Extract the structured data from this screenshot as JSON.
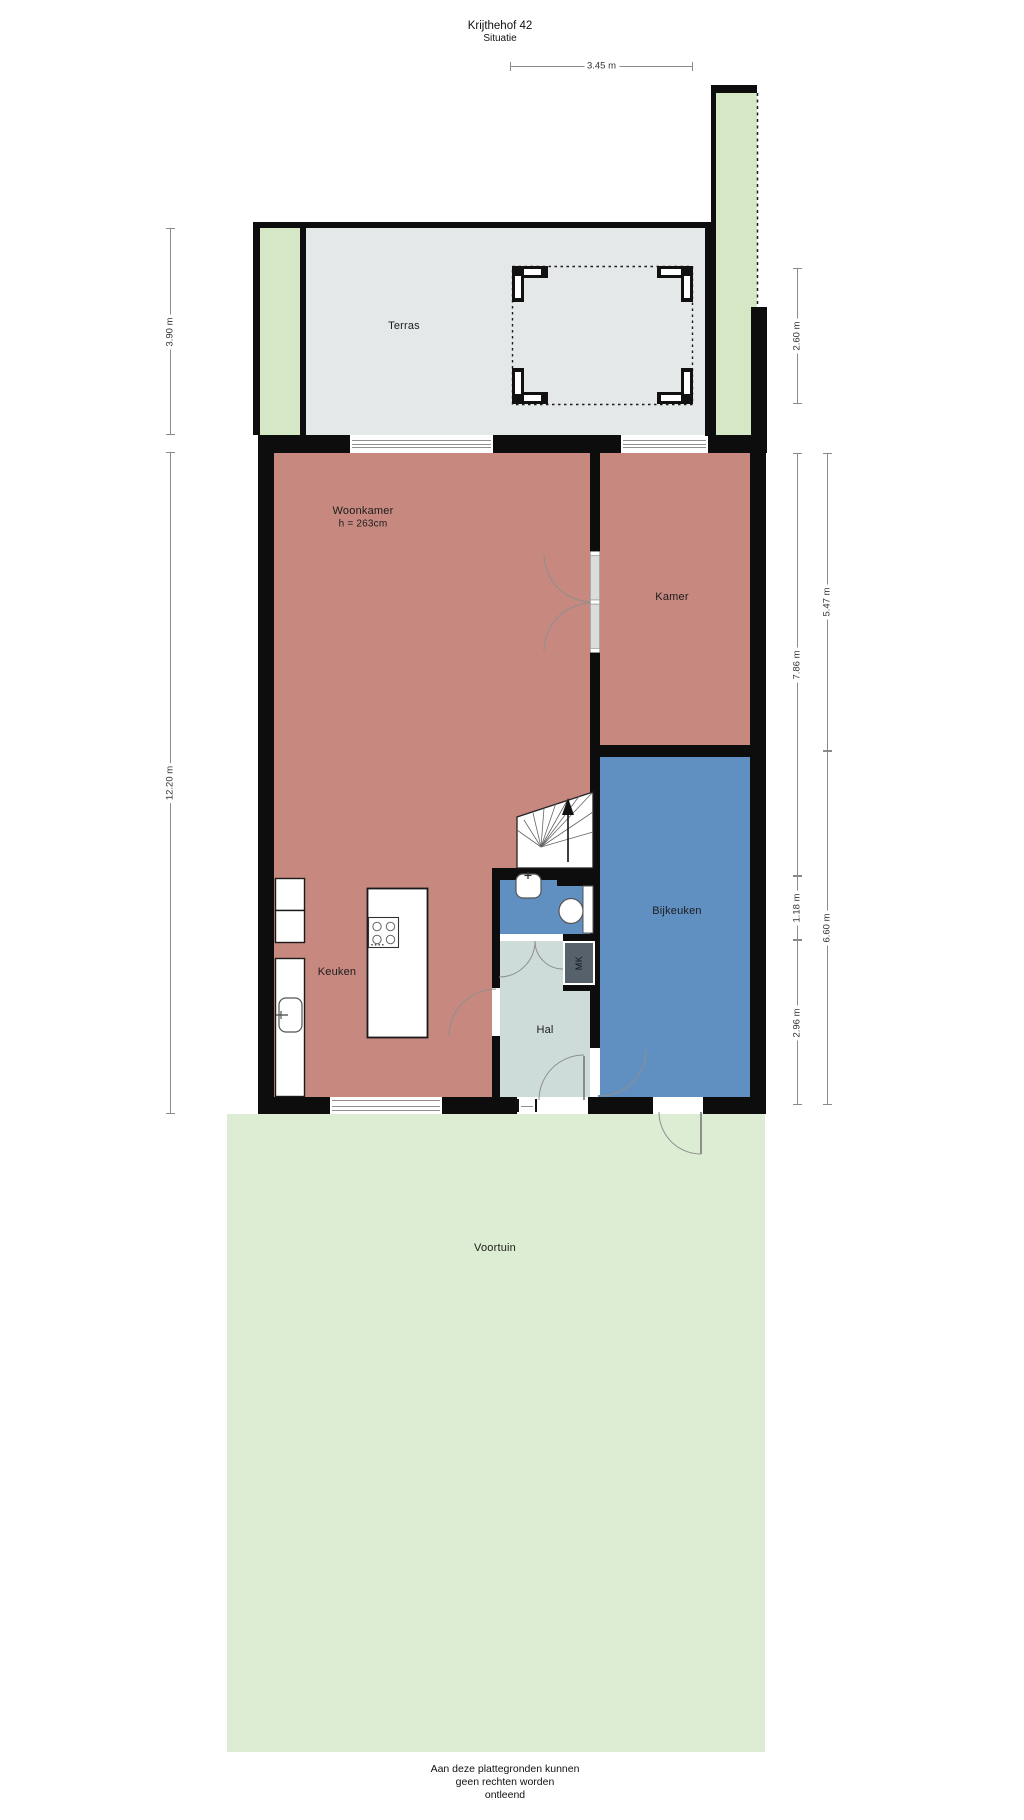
{
  "title": {
    "name": "Krijthehof 42",
    "subtitle": "Situatie"
  },
  "floor": {
    "rooms": {
      "terras": "Terras",
      "woonkamer": "Woonkamer",
      "woonkamer_height": "h = 263cm",
      "kamer": "Kamer",
      "keuken": "Keuken",
      "hal": "Hal",
      "bijkeuken": "Bijkeuken",
      "mk": "MK",
      "voortuin": "Voortuin"
    }
  },
  "dimensions": {
    "pergola_width": "3.45 m",
    "terrace_left": "3.90 m",
    "house_left": "12.20 m",
    "pergola_height": "2.60 m",
    "right_inner_top": "7.86 m",
    "right_inner_mid": "1.18 m",
    "right_inner_bottom": "2.96 m",
    "right_outer_top": "5.47 m",
    "right_outer_bottom": "6.60 m"
  },
  "footer": {
    "line1": "Aan deze plattegronden kunnen",
    "line2": "geen rechten worden",
    "line3": "ontleend"
  },
  "colors": {
    "wall": "#0d0d0d",
    "living": "#c6887f",
    "utility_blue": "#6090c2",
    "hall": "#cddbd9",
    "terrace": "#e4e8e9",
    "garden": "#dcedd3",
    "garden_strip": "#d6e7c6",
    "mk": "#57616b"
  }
}
